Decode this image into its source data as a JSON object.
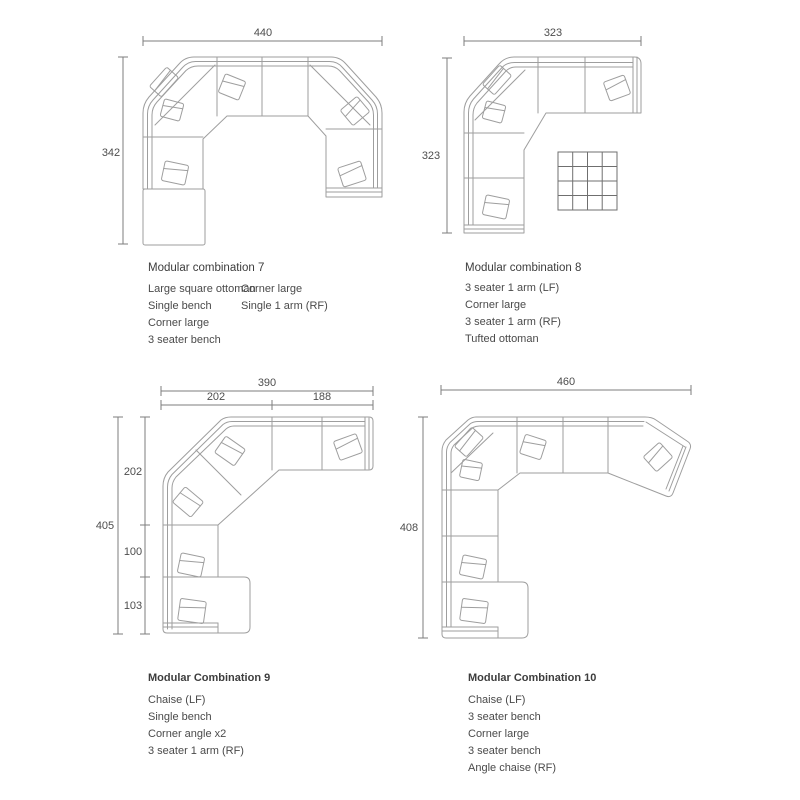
{
  "page": {
    "background": "#ffffff"
  },
  "colors": {
    "sofa_line": "#9e9e9e",
    "dimension_line": "#7d7d7d",
    "text": "#4a4a4a",
    "title": "#3d3d3d",
    "ottoman_grid": "#6f6f6f"
  },
  "combos": {
    "c7": {
      "title": "Modular combination 7",
      "dim_width": "440",
      "dim_height": "342",
      "parts_col1": [
        "Large square ottoman",
        "Single bench",
        "Corner large",
        "3 seater bench"
      ],
      "parts_col2": [
        "Corner large",
        "Single 1 arm (RF)"
      ]
    },
    "c8": {
      "title": "Modular combination 8",
      "dim_width": "323",
      "dim_height": "323",
      "parts": [
        "3 seater 1 arm (LF)",
        "Corner large",
        "3 seater 1 arm (RF)",
        "Tufted ottoman"
      ]
    },
    "c9": {
      "title": "Modular Combination 9",
      "dim_width": "390",
      "dim_height": "405",
      "width_segments": [
        "202",
        "188"
      ],
      "height_segments": [
        "202",
        "100",
        "103"
      ],
      "parts": [
        "Chaise (LF)",
        "Single bench",
        "Corner angle x2",
        "3 seater 1 arm (RF)"
      ]
    },
    "c10": {
      "title": "Modular Combination 10",
      "dim_width": "460",
      "dim_height": "408",
      "parts": [
        "Chaise (LF)",
        "3 seater bench",
        "Corner large",
        "3 seater bench",
        "Angle chaise (RF)"
      ]
    }
  }
}
